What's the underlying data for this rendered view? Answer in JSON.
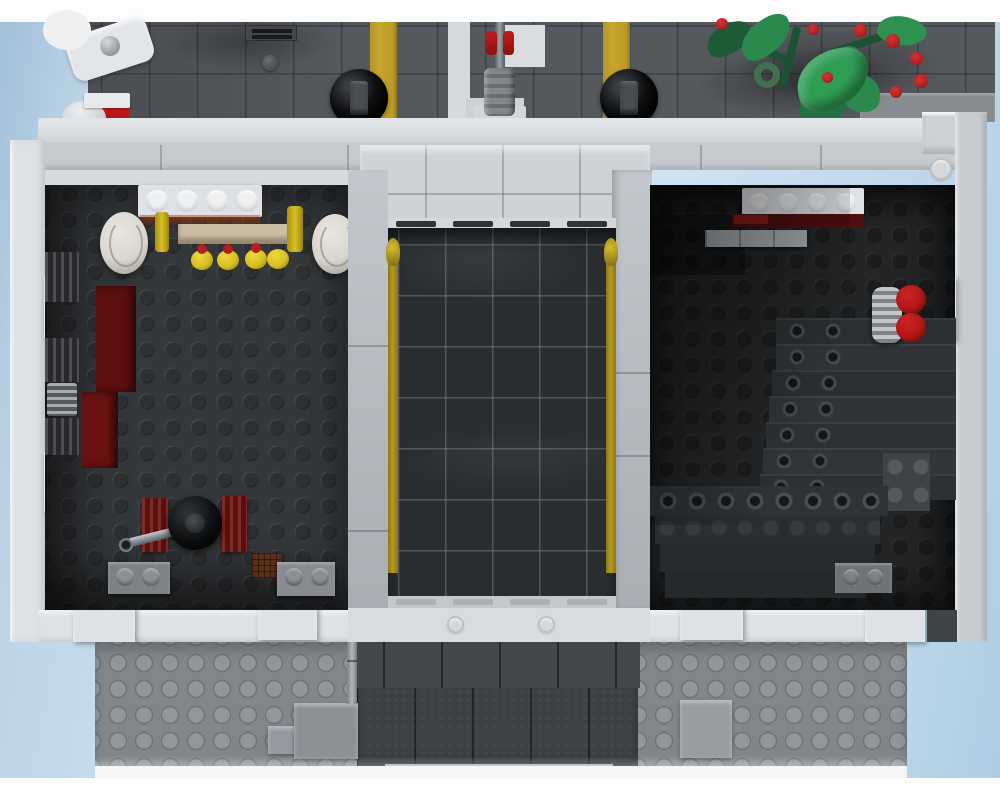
{
  "scene": {
    "title": "Top-down render of a LEGO modular building interior with street, stairwell shaft and two rooms",
    "stud_embossing_text": "LEGO"
  },
  "colors": {
    "bg_page": "#fdfdfe",
    "sky_left": "#a3c0d8",
    "sky_mid": "#cfe2f0",
    "sky_right": "#b7d3e7",
    "street": "#55585c",
    "yellow_stripe": "#c7a62c",
    "path_white": "#d6dadd",
    "wall_light": "#c6cbd0",
    "wall_white": "#dee2e6",
    "interior_left": "#35383b",
    "interior_right": "#232527",
    "shaft": "#2b2e31",
    "accent_yellow": "#b49b1e",
    "baseplate": "#82868b",
    "red": "#b01616",
    "dark_red": "#5e1010",
    "berry_red": "#b42222",
    "leaf_green": "#2f9e55",
    "leaf_dark": "#1d5a36",
    "tan": "#c9bda4",
    "piece_yellow": "#d8bf24",
    "barrel_white": "#d9d6cf",
    "black_piece": "#101113"
  },
  "elements": {
    "street": "dark gray street baseplate with tile grooves",
    "lane_marking_left": "yellow lane stripe (left)",
    "lane_marking_right": "yellow lane stripe (right)",
    "sidewalk_path": "light tile walkway",
    "storm_grille": "street drain grille tile",
    "manhole": "round utility stud on street",
    "tire_left": "black round piece on street (left)",
    "tire_right": "black round piece on street (right)",
    "lamp_post": "gray lamp post with red clips seen from above",
    "wall_lamp": "white wall-mounted lamp bracket",
    "barrier": "red and white street barrier",
    "plant": "green plant with red berries overhanging the street",
    "curb": "gray curb strip under plant",
    "building": "building shell seen from above",
    "top_wall": "front wall band with sill",
    "left_wall": "left outer wall with inset teeth",
    "right_wall": "right outer wall with inset tooth",
    "bottom_wall": "back wall band with teeth",
    "left_room": "left room with dark studded floor",
    "bar_counter": "white 1x4 brick counter with studs",
    "barrels": "two white barrels behind the counter",
    "shelf": "tan shelf",
    "candelabra": "yellow goblets with red candles",
    "weapon_racks": "dark lattice racks on left wall",
    "red_brick_wall": "dark red interior brick wall",
    "cannon": "black-wheeled cannon with silver barrel",
    "ladder_racks": "dark red ladder pieces",
    "crate": "brown crate",
    "floor_bricks": "loose gray bricks on floor",
    "stairwell_shaft": "central shaft with glossy black tiles",
    "yellow_rails": "yellow rails along shaft sides",
    "right_room": "right room with dark floor and staircase",
    "right_counter": "white 1x4 brick over dark red plate",
    "extinguisher": "silver and red round pieces on right wall",
    "stair_upper_flight": "staircase flight along right wall",
    "stair_lower_flight": "staircase flight along back wall",
    "baseplate": "bottom gray studded baseplate",
    "roof_panels": "dark gray panels at bottom center",
    "slope_bricks": "light gray slope bricks",
    "pipe": "thin gray pipe"
  }
}
